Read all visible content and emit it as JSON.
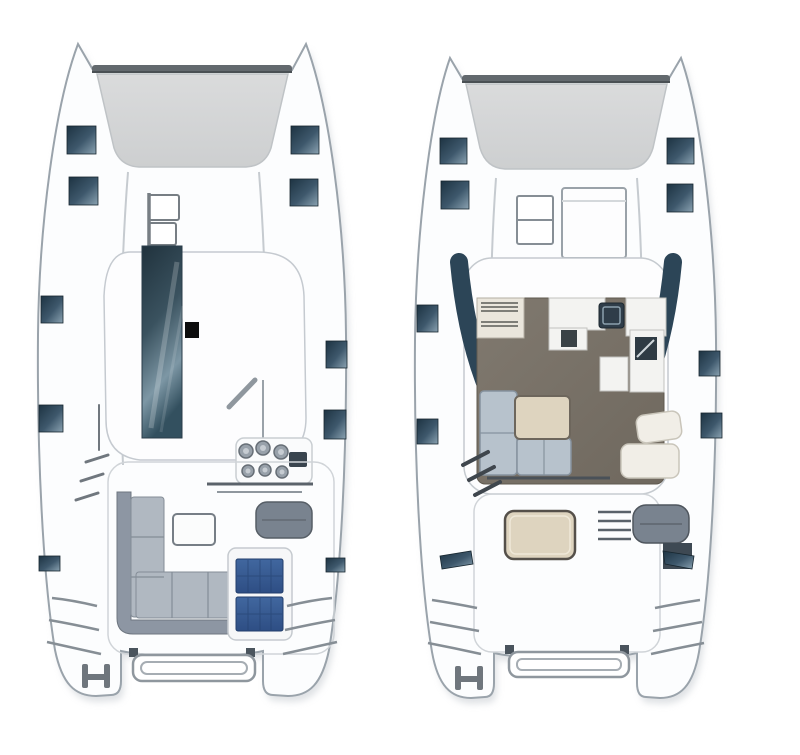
{
  "canvas": {
    "width": 800,
    "height": 755,
    "background": "#ffffff"
  },
  "figure": {
    "type": "diagram",
    "subject": "catamaran-yacht-floor-plans",
    "views": [
      {
        "id": "deck-plan",
        "name": "exterior-deck-plan",
        "features": [
          "bow-crossbeam",
          "trampoline",
          "foredeck-hatch",
          "coachroof",
          "cabin-window-strip",
          "mast-step",
          "boom",
          "winches",
          "mainsheet-traveler",
          "cockpit-sofa",
          "cockpit-table",
          "helm-seat",
          "solar-panels",
          "boarding-steps",
          "transom-steps",
          "davit-frame",
          "stern-cleat",
          "hull-windows"
        ]
      },
      {
        "id": "interior-plan",
        "name": "interior-saloon-plan",
        "features": [
          "bow-crossbeam",
          "trampoline",
          "forward-sunpad",
          "companionway",
          "saloon",
          "galley-counter",
          "stove",
          "sink",
          "fridge",
          "saloon-floor",
          "dinette-settee",
          "dinette-table",
          "chaise-cushions",
          "companionway-steps",
          "cockpit-table",
          "helm-seat",
          "helm-steps",
          "transom-steps",
          "davit-frame",
          "stern-cleat",
          "hull-windows"
        ]
      }
    ]
  },
  "colors": {
    "background": "#ffffff",
    "hull_fill": "#fcfdfe",
    "hull_outline": "#9aa3ab",
    "hull_shadow": "#c6cbd0",
    "deck_line": "#c6cbd0",
    "crossbeam": "#63696e",
    "trampoline": "#dadbdc",
    "trampoline_dark": "#cdcfd0",
    "window_dark": "#1d3342",
    "window_mid": "#3e586c",
    "window_light": "#8ba3b2",
    "glass_dark": "#20323d",
    "glass_mid": "#3a525f",
    "glass_light": "#7d97a5",
    "mast": "#0d0d0d",
    "boom": "#8f979e",
    "winch": "#98a1aa",
    "winch_rim": "#666e76",
    "instrument": "#39444e",
    "sofa_back": "#8d96a3",
    "sofa_seat": "#b0b8c1",
    "table_white": "#fbfcfc",
    "helm_seat": "#79838f",
    "solar_top": "#41679f",
    "solar_bottom": "#2e4e84",
    "solar_grid": "#223e6b",
    "saloon_floor_light": "#80796f",
    "saloon_floor_dark": "#6f685e",
    "galley_counter": "#eae6dc",
    "counter_white": "#f3f3f1",
    "sink": "#2f3d49",
    "appliance": "#2f3b44",
    "settee": "#b7c2cc",
    "settee_edge": "#86929e",
    "table_beige": "#ded4bf",
    "chaise": "#f1eee7",
    "saloon_window": "#2c4557",
    "step_dark": "#3f464d",
    "frame_gray": "#8f979e",
    "cleat_gray": "#6f767d"
  }
}
